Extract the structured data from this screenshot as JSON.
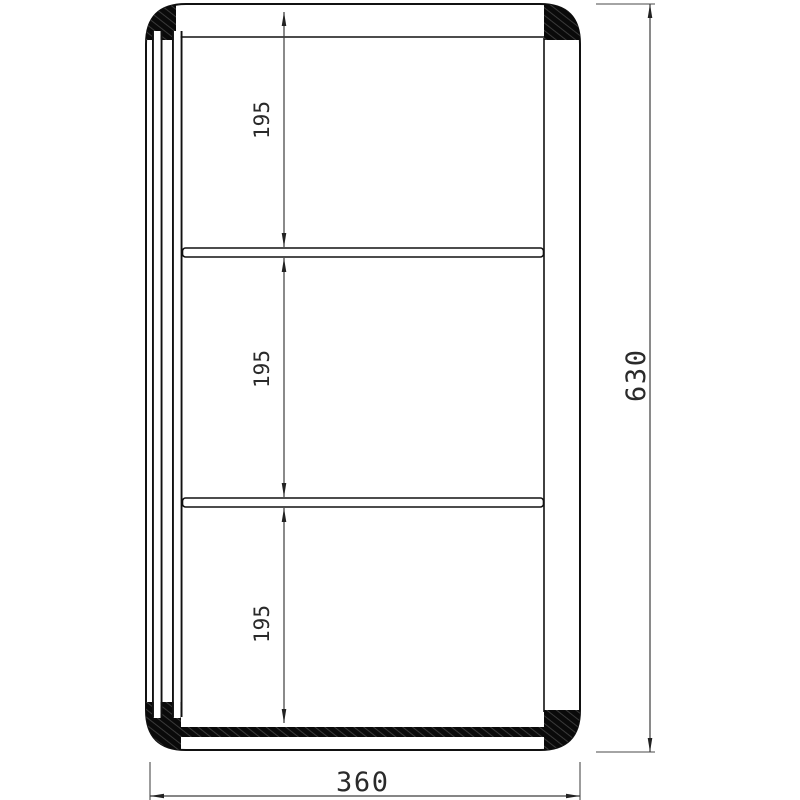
{
  "drawing": {
    "dimensions": {
      "section_top": "195",
      "section_middle": "195",
      "section_bottom": "195",
      "overall_height": "630",
      "overall_width": "360"
    },
    "colors": {
      "object_line": "#111111",
      "dimension_line": "#3d3d3d",
      "fill_block": "#0a0a0a",
      "background": "#ffffff"
    }
  }
}
